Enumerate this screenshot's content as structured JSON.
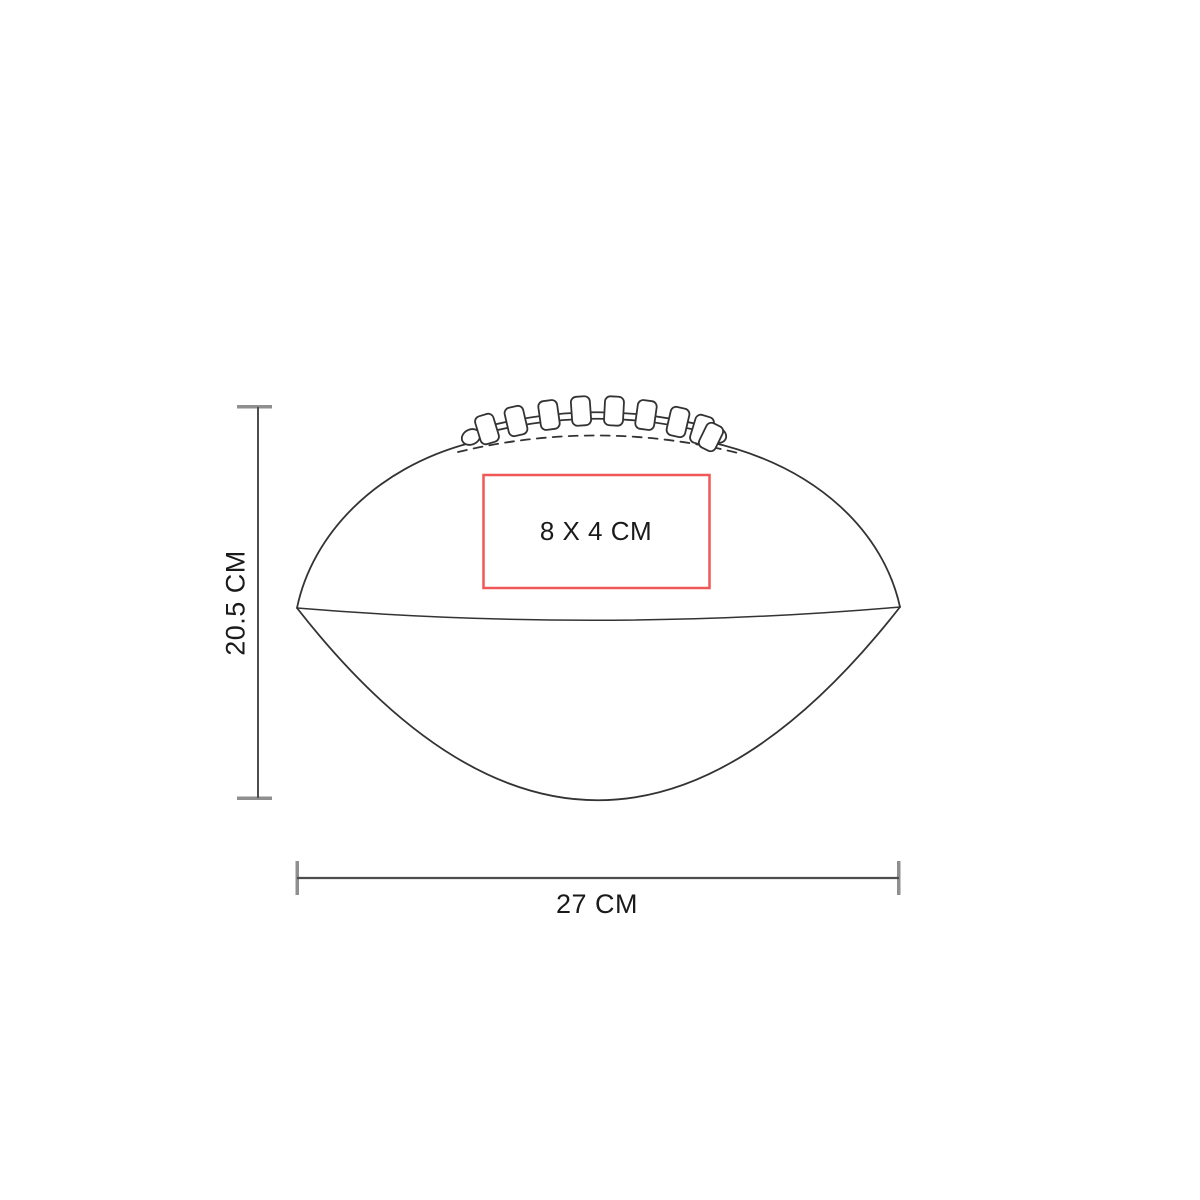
{
  "diagram": {
    "print_area": {
      "label": "8 X 4 CM",
      "border_color": "#f05757"
    },
    "height_dimension": {
      "label": "20.5 CM"
    },
    "width_dimension": {
      "label": "27 CM"
    }
  },
  "icons": {
    "product_shape": "american-football-line-art",
    "laces": "football-laces",
    "print_area": "print-area-rectangle"
  },
  "colors": {
    "background": "#ffffff",
    "artwork_line": "#333333",
    "dimension_line": "#4d4d4d",
    "dimension_cap": "#8f8f8f",
    "print_area_border": "#f05757",
    "label_text": "#1a1a1a"
  }
}
